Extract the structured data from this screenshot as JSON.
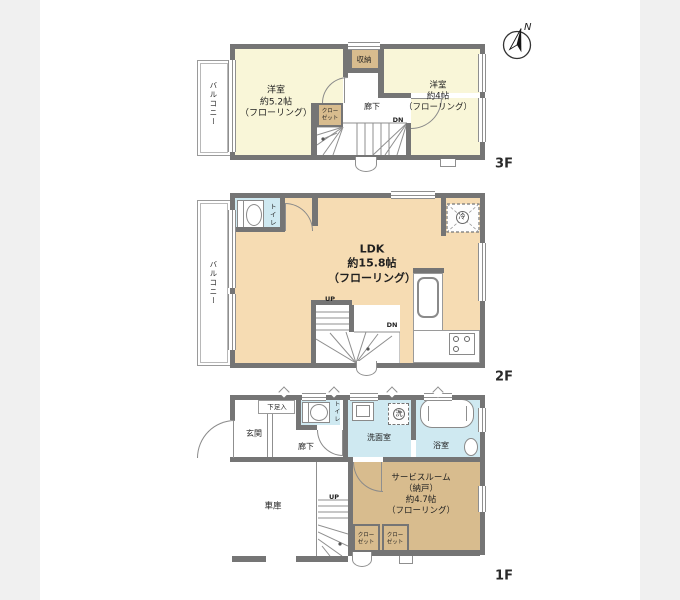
{
  "compass": {
    "north_label": "N"
  },
  "colors": {
    "wall": "#757575",
    "room-yellow": "#f9f6d8",
    "room-peach": "#f6dcb3",
    "room-tan": "#d8bc8e",
    "room-blue": "#cfe9f1",
    "line": "#8f8f8f",
    "text": "#1f1f1f",
    "bg": "#f0f0f0"
  },
  "floor3": {
    "floor_label": "3F",
    "balcony": "バルコニー",
    "room_west": "洋室\n約5.2帖\n（フローリング）",
    "room_east": "洋室\n約4帖\n（フローリング）",
    "storage": "収納",
    "closet": "クロー\nゼット",
    "hallway": "廊下",
    "stairs_dn": "DN"
  },
  "floor2": {
    "floor_label": "2F",
    "balcony": "バルコニー",
    "toilet": "トイレ",
    "ldk": "LDK\n約15.8帖\n（フローリング）",
    "fridge": "冷",
    "stairs_up": "UP",
    "stairs_dn": "DN"
  },
  "floor1": {
    "floor_label": "1F",
    "entrance": "玄関",
    "shoe_box": "下足入",
    "toilet": "トイレ",
    "washroom": "洗面室",
    "washer": "洗",
    "bathroom": "浴室",
    "hallway": "廊下",
    "garage": "車庫",
    "service_room": "サービスルーム\n（納戸）\n約4.7帖\n（フローリング）",
    "closet1": "クロー\nゼット",
    "closet2": "クロー\nゼット",
    "stairs_up": "UP"
  }
}
